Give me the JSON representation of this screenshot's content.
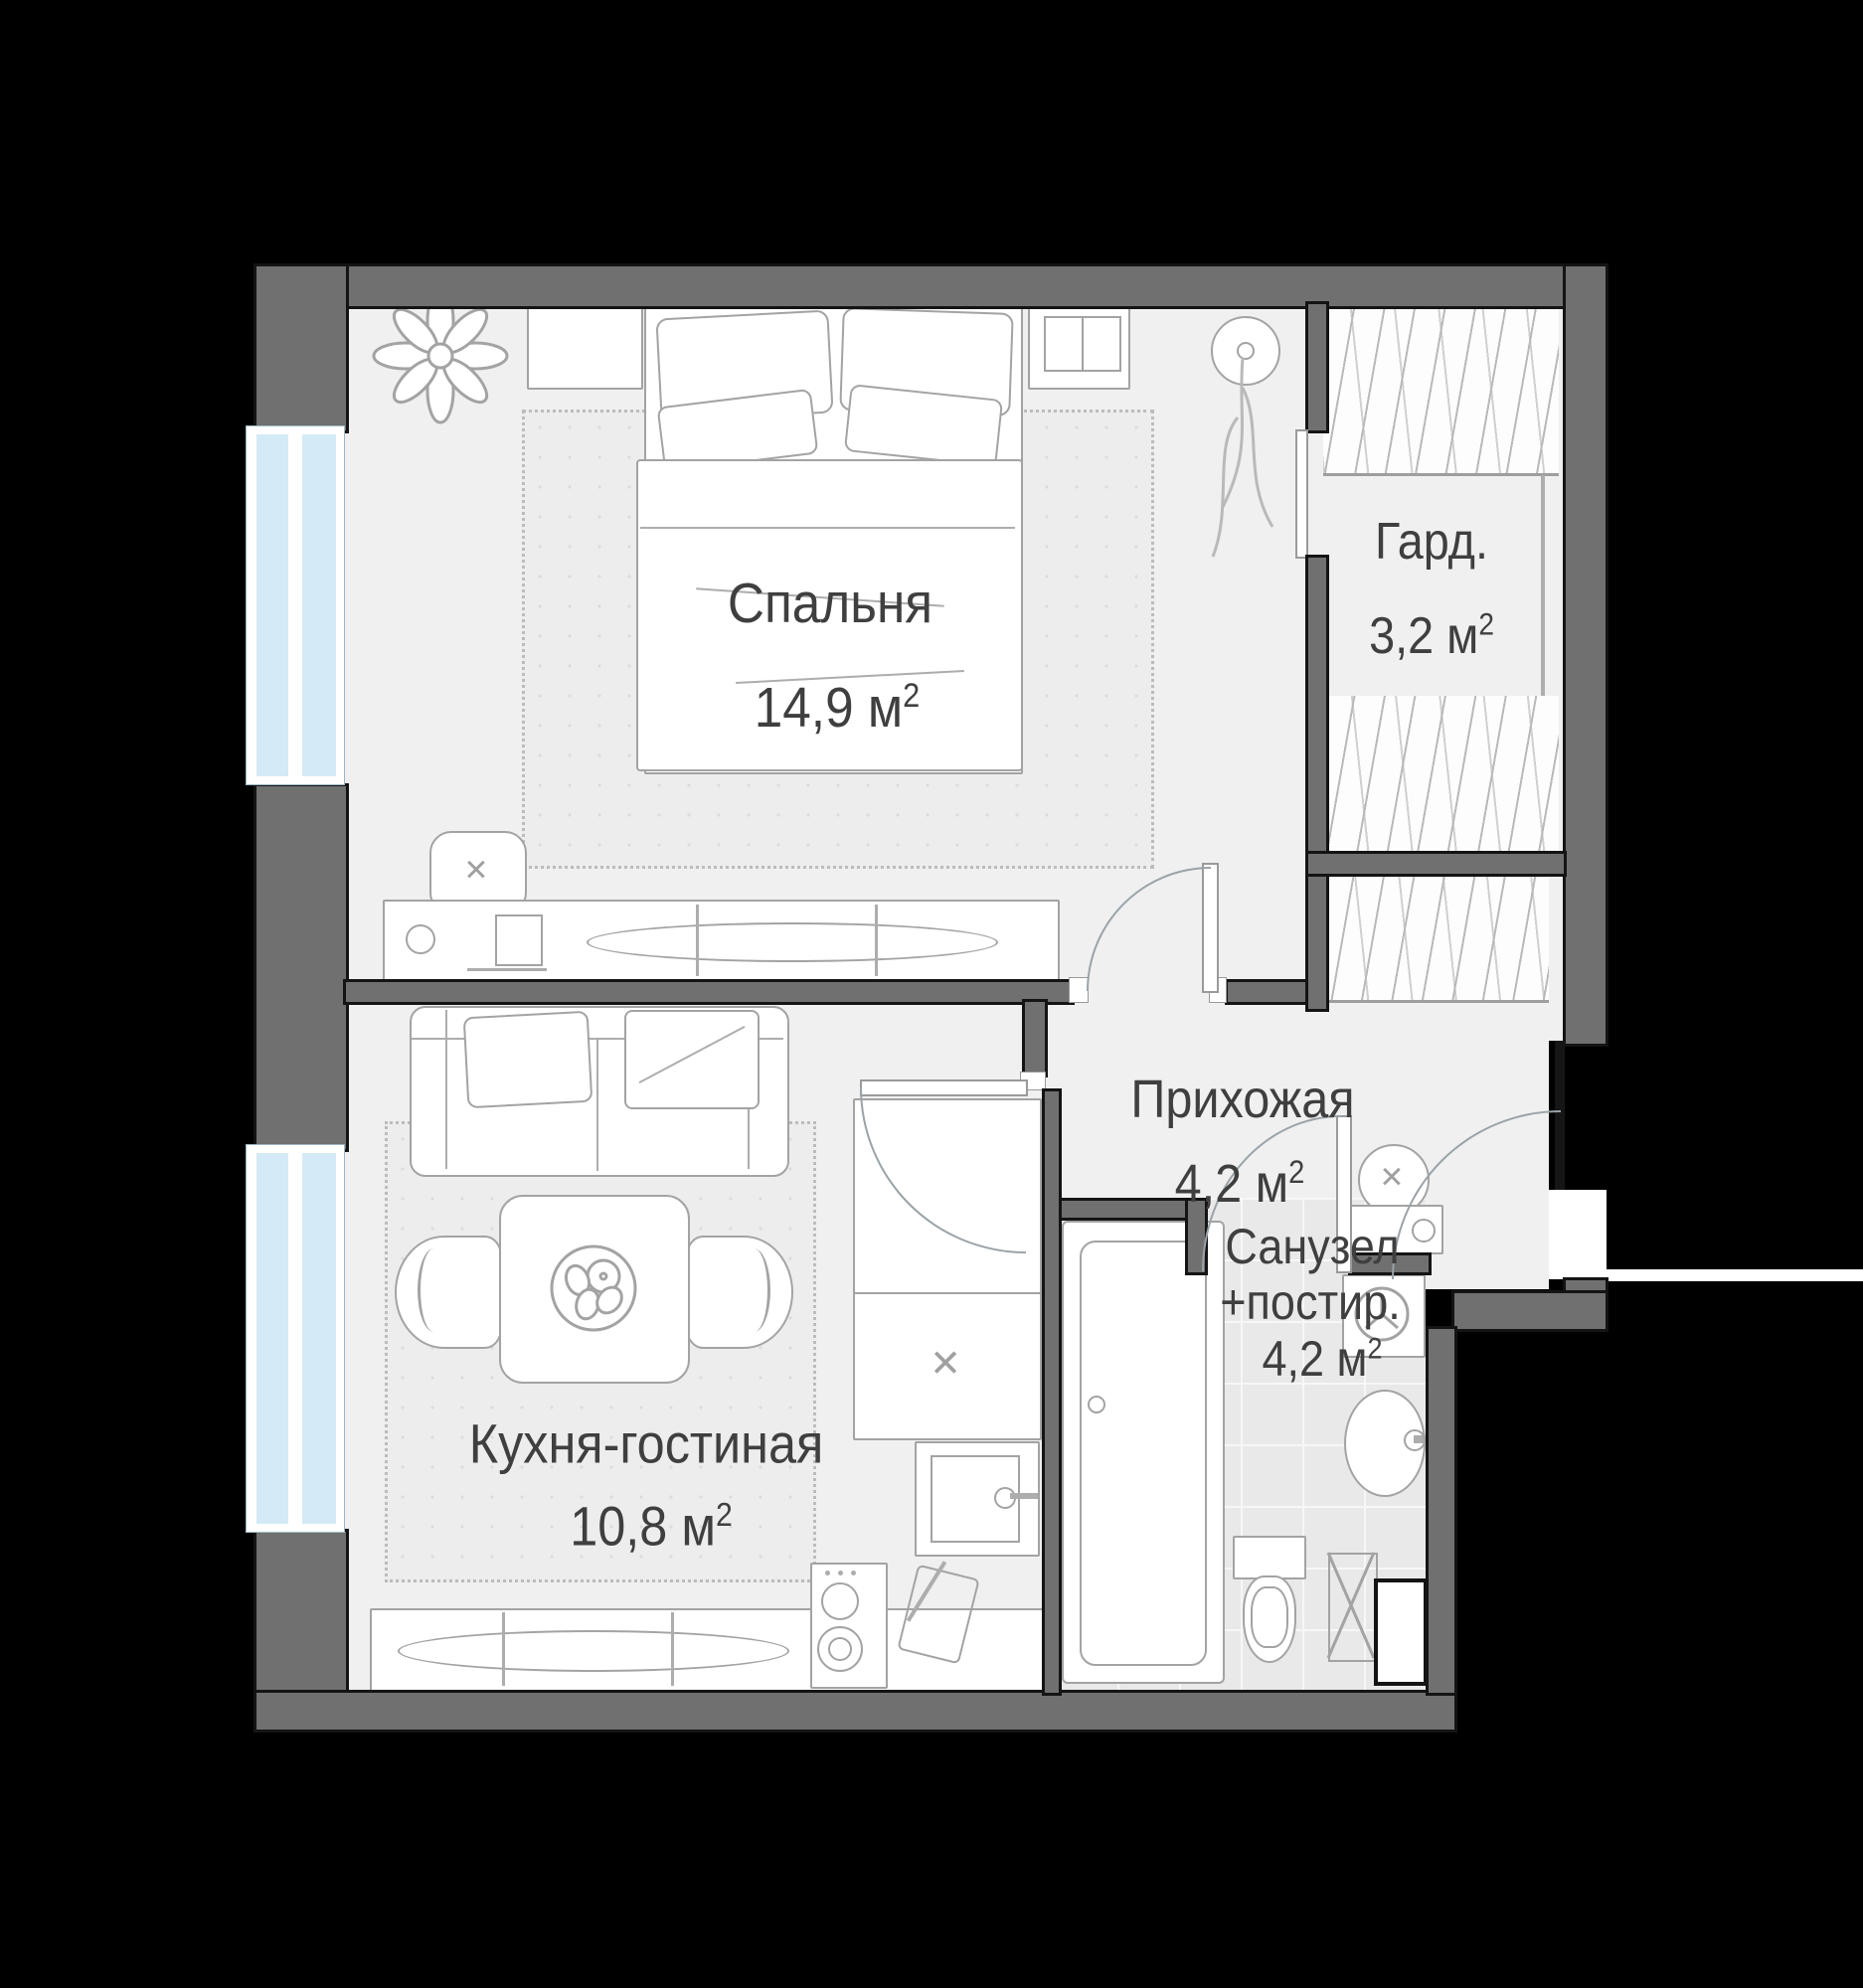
{
  "plan": {
    "rooms": {
      "bedroom": {
        "name": "Спальня",
        "area": "14,9",
        "unit": "м",
        "sup": "2"
      },
      "wardrobe": {
        "name": "Гард.",
        "area": "3,2",
        "unit": "м",
        "sup": "2"
      },
      "hallway": {
        "name": "Прихожая",
        "area": "4,2",
        "unit": "м",
        "sup": "2"
      },
      "kitchen_living": {
        "name": "Кухня-гостиная",
        "area": "10,8",
        "unit": "м",
        "sup": "2"
      },
      "bathroom": {
        "name_line1": "Санузел",
        "name_line2": "+постир.",
        "area": "4,2",
        "unit": "м",
        "sup": "2"
      }
    },
    "icons": {
      "cross": "✕"
    },
    "colors": {
      "background": "#000000",
      "wall": "#707070",
      "wall_line": "#141414",
      "floor": "#f0f0f0",
      "tile": "#e9e9e9",
      "window_glass": "#d4eaf6",
      "furniture_stroke": "#a3a3a3",
      "text": "#3f3f3f"
    }
  }
}
